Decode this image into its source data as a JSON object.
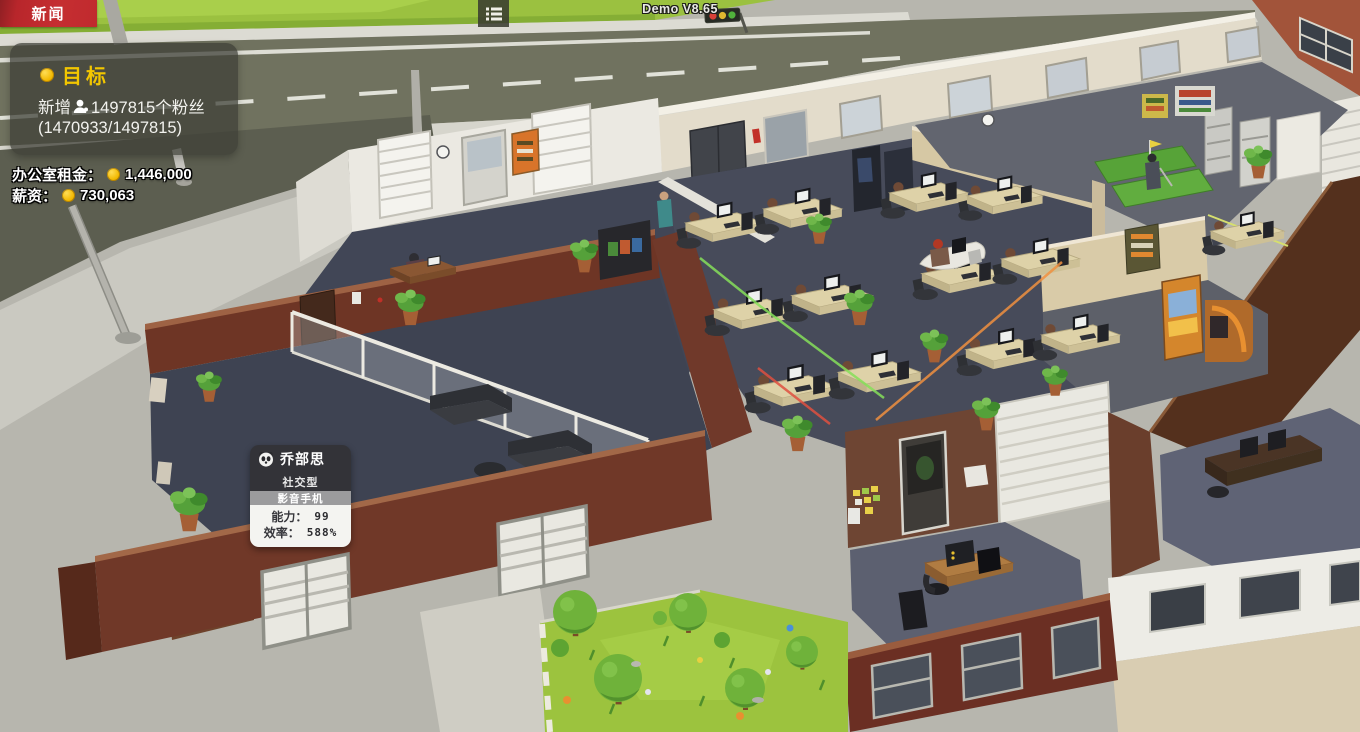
{
  "hud": {
    "news": "新闻",
    "version": "Demo V8.65",
    "goal": {
      "title": "目标",
      "line1_prefix": "新增",
      "line1_suffix": "1497815个粉丝",
      "line2": "(1470933/1497815)"
    },
    "rent_label": "办公室租金：",
    "rent_value": "1,446,000",
    "salary_label": "薪资：",
    "salary_value": "730,063"
  },
  "tooltip": {
    "name": "乔部思",
    "type": "社交型",
    "item": "影音手机",
    "ability_label": "能力：",
    "ability_value": "99",
    "efficiency_label": "效率：",
    "efficiency_value": "588%"
  },
  "icons": {
    "goal_bullet": "coin-icon",
    "fans": "person-icon",
    "menu": "list-icon",
    "tooltip_avatar": "panda-icon",
    "currency": "coin-icon"
  },
  "colors": {
    "news_red": "#c02a2e",
    "goal_yellow": "#f2c600",
    "coin_yellow": "#f2b800",
    "panel_bg": "rgba(62,64,55,0.74)",
    "road": "#70725f",
    "grass": "#9bc140",
    "brick_wall": "#703828",
    "office_floor": "#474b5a",
    "cream_wall": "#e3dccb",
    "lawn": "#9cc33e"
  }
}
